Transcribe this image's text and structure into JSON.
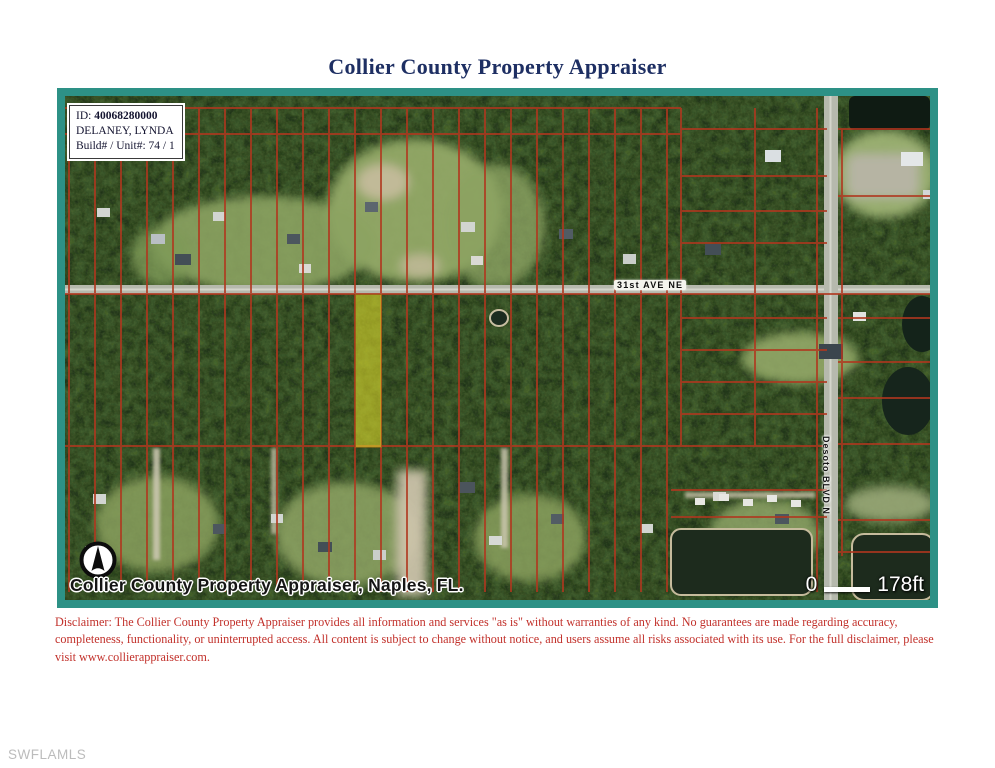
{
  "title": "Collier County Property Appraiser",
  "info_box": {
    "id_label": "ID:",
    "id_value": "40068280000",
    "owner": "DELANEY, LYNDA",
    "build_unit": "Build# / Unit#: 74 / 1"
  },
  "map": {
    "street_label": "31st AVE NE",
    "blvd_label": "Desoto BLVD N",
    "credit": "Collier County Property Appraiser, Naples, FL.",
    "scale_start": "0",
    "scale_label": "178ft",
    "highlight_color": "#d6d42a",
    "parcel_line_color": "#b0371f",
    "frame_color": "#2d9186"
  },
  "disclaimer": "Disclaimer: The Collier County Property Appraiser provides all information and services \"as is\" without warranties of any kind. No guarantees are made regarding accuracy, completeness, functionality, or uninterrupted access. All content is subject to change without notice, and users assume all risks associated with its use. For the full disclaimer, please visit www.collierappraiser.com.",
  "watermark": "SWFLAMLS"
}
